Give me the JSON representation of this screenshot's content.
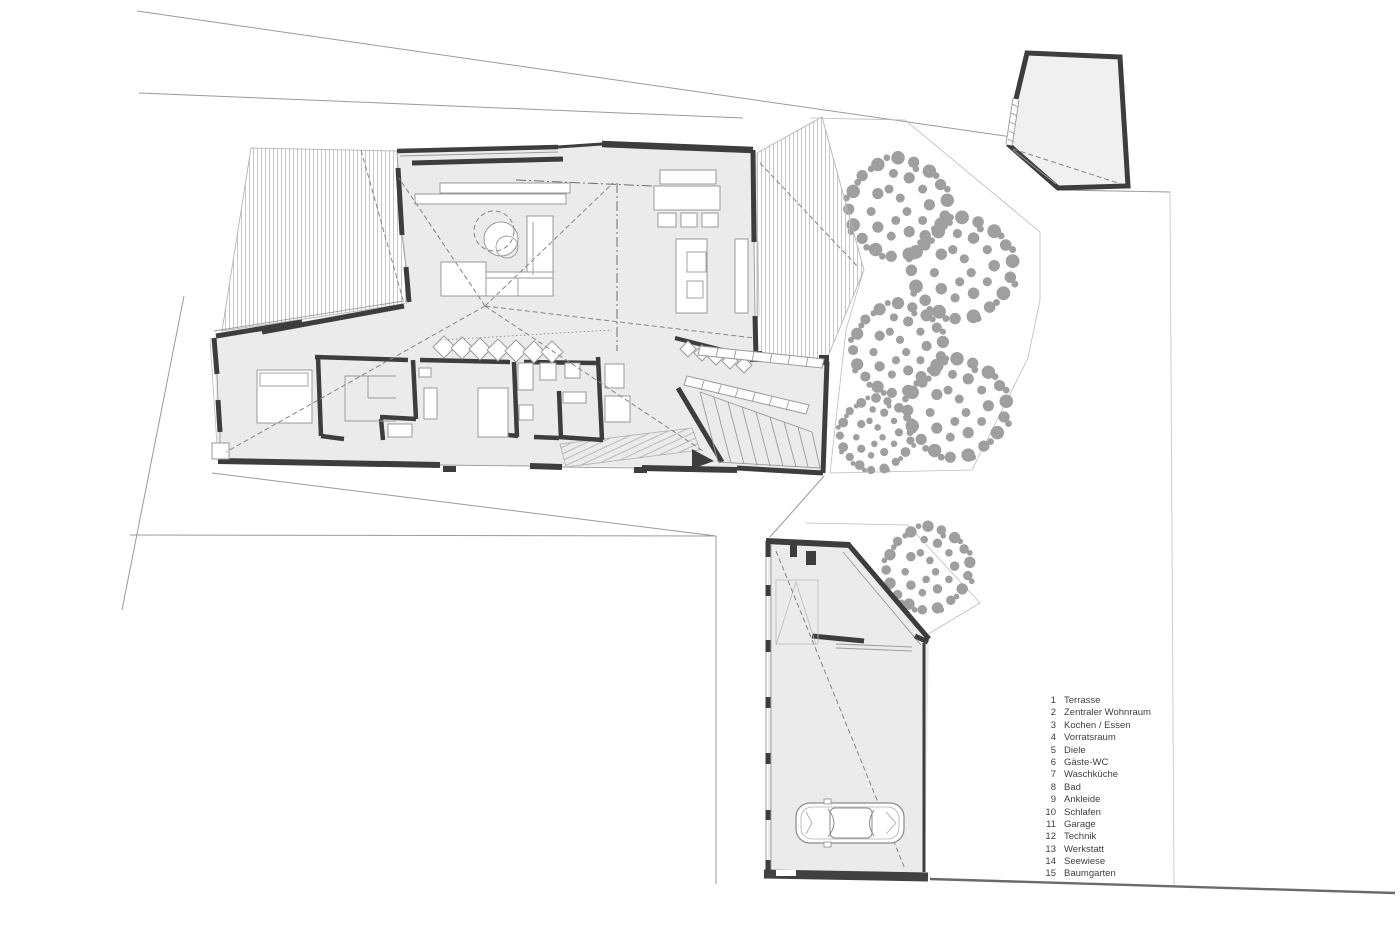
{
  "colors": {
    "background": "#ffffff",
    "wall": "#3d3d3d",
    "floor": "#ebebeb",
    "tree": "#9f9f9f",
    "boundary": "#9a9a9a",
    "hatch": "#c2c2c2",
    "furniture": "#9a9a9a",
    "text": "#3f3f3f"
  },
  "symbols": {
    "car": "car-top-view-icon",
    "tree": "tree-canopy-icon",
    "entry_marker": "entry-arrow-icon",
    "stairs": "staircase-treads",
    "terraces": "hatched-terrace",
    "trees_area": "tree-garden"
  },
  "legend": {
    "items": [
      {
        "num": "1",
        "label": "Terrasse"
      },
      {
        "num": "2",
        "label": "Zentraler Wohnraum"
      },
      {
        "num": "3",
        "label": "Kochen / Essen"
      },
      {
        "num": "4",
        "label": "Vorratsraum"
      },
      {
        "num": "5",
        "label": "Diele"
      },
      {
        "num": "6",
        "label": "Gäste-WC"
      },
      {
        "num": "7",
        "label": "Waschküche"
      },
      {
        "num": "8",
        "label": "Bad"
      },
      {
        "num": "9",
        "label": "Ankleide"
      },
      {
        "num": "10",
        "label": "Schlafen"
      },
      {
        "num": "11",
        "label": "Garage"
      },
      {
        "num": "12",
        "label": "Technik"
      },
      {
        "num": "13",
        "label": "Werkstatt"
      },
      {
        "num": "14",
        "label": "Seewiese"
      },
      {
        "num": "15",
        "label": "Baumgarten"
      }
    ]
  }
}
